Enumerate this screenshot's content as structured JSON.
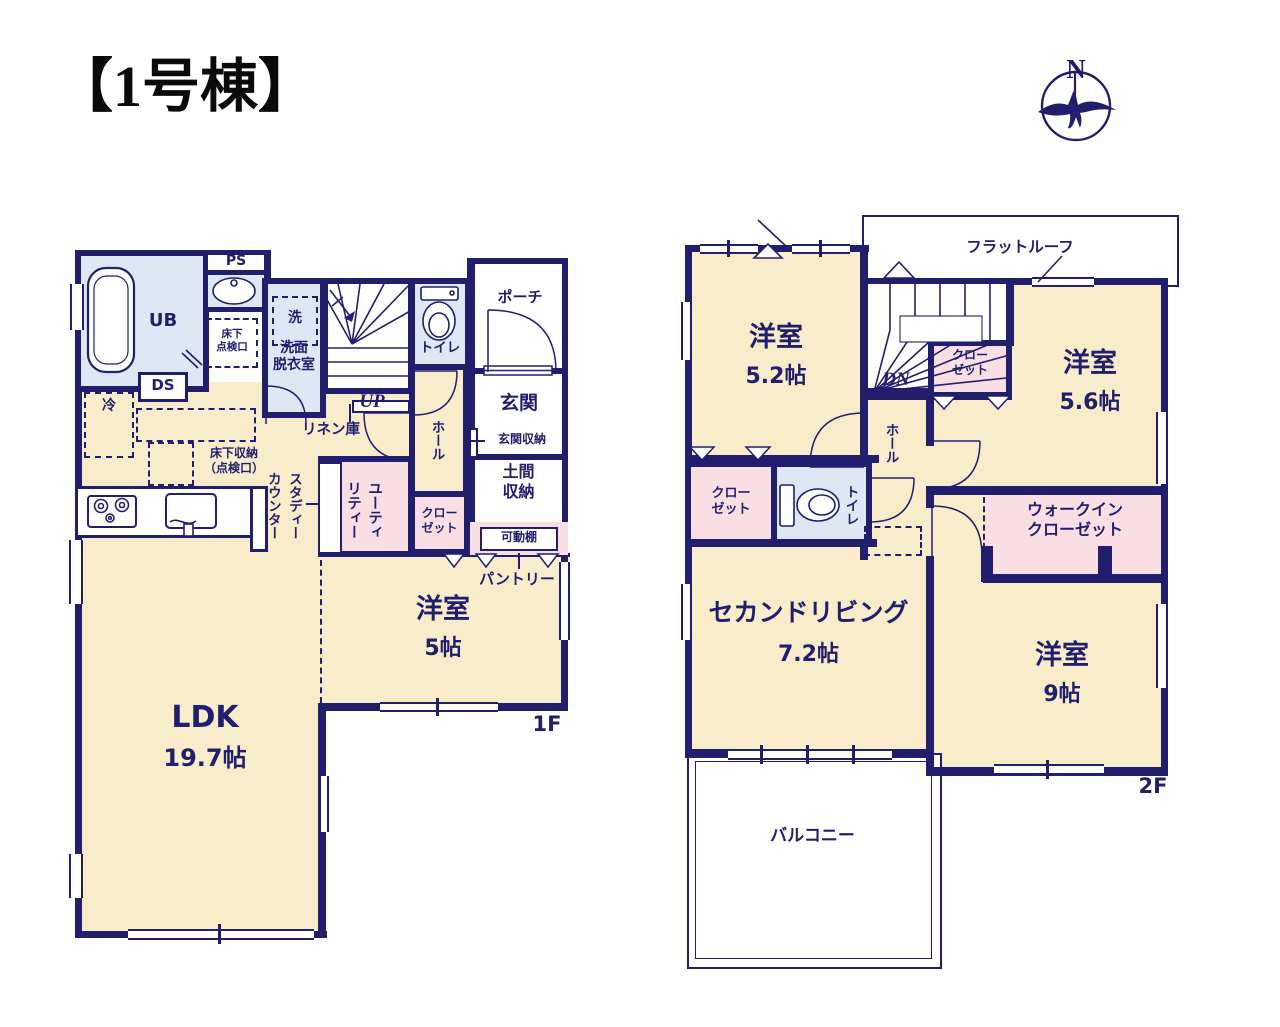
{
  "title": "【1号棟】",
  "compass": {
    "north": "N",
    "icon": "compass-bird-icon"
  },
  "colors": {
    "wall": "#221e6e",
    "text": "#221e6e",
    "room_cream": "#f8ecca",
    "room_pink": "#f9dfe4",
    "room_blue": "#dce9f4"
  },
  "floor1": {
    "floor_label": "1F",
    "labels": {
      "ub": "UB",
      "ps": "PS",
      "ds": "DS",
      "fridge": "冷",
      "washer": "洗",
      "washroom": "洗面\n脱衣室",
      "underfloor_hatch": "床下\n点検口",
      "underfloor_storage": "床下収納\n（点検口）",
      "toilet": "トイレ",
      "hall": "ホール",
      "porch": "ポーチ",
      "entrance": "玄関",
      "entrance_storage": "玄関収納",
      "dirt_floor_storage": "土間\n収納",
      "movable_shelf": "可動棚",
      "pantry": "パントリー",
      "closet": "クロー\nゼット",
      "utility": "ユーティ\nリティー",
      "study_counter": "スタディー\nカウンター",
      "linen": "リネン庫",
      "up": "UP",
      "bedroom": "洋室",
      "bedroom_size": "5帖",
      "ldk": "LDK",
      "ldk_size": "19.7帖"
    }
  },
  "floor2": {
    "floor_label": "2F",
    "labels": {
      "flat_roof": "フラットルーフ",
      "dn": "DN",
      "hall": "ホール",
      "closet_a": "クロー\nゼット",
      "closet_b": "クロー\nゼット",
      "bedroom52": "洋室",
      "bedroom52_size": "5.2帖",
      "bedroom56": "洋室",
      "bedroom56_size": "5.6帖",
      "second_living": "セカンドリビング",
      "second_living_size": "7.2帖",
      "toilet": "トイレ",
      "walk_in_closet": "ウォークイン\nクローゼット",
      "bedroom9": "洋室",
      "bedroom9_size": "9帖",
      "balcony": "バルコニー"
    }
  }
}
